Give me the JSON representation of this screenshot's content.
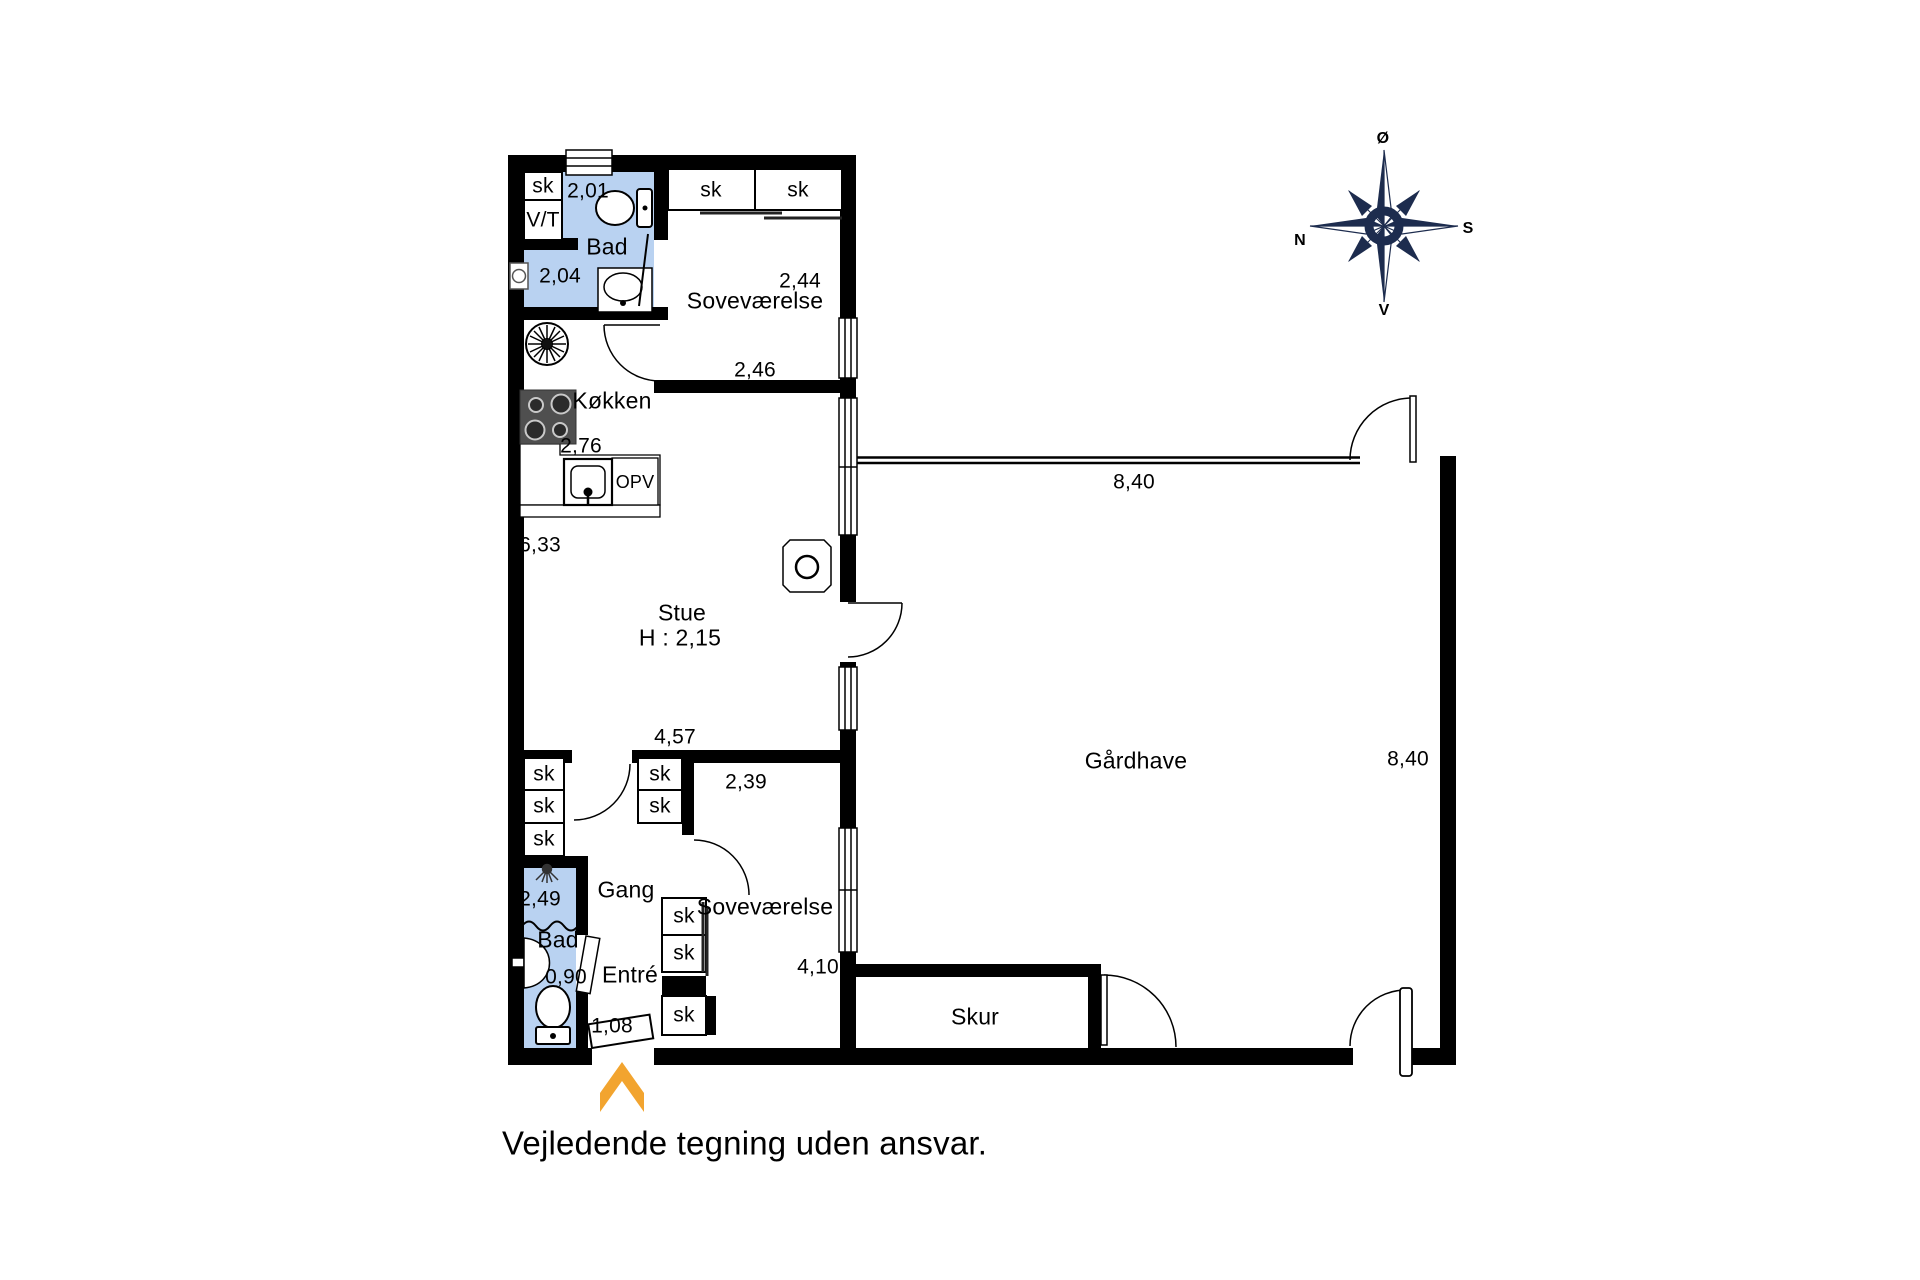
{
  "note": "Vejledende tegning uden ansvar.",
  "colors": {
    "wall": "#000000",
    "wet_room_fill": "#b9d2f1",
    "compass": "#1d2c4e",
    "entrance_arrow": "#F2A42F",
    "appliance_dark": "#4f4f4f"
  },
  "compass": {
    "north": "N",
    "south": "S",
    "east": "Ø",
    "west": "V"
  },
  "rooms": {
    "bathroom_top": {
      "name": "Bad",
      "closet": "sk",
      "washer": "V/T",
      "dim_width": "2,01",
      "dim_depth": "2,04"
    },
    "bedroom_top": {
      "name": "Soveværelse",
      "closets": [
        "sk",
        "sk"
      ],
      "dim_width": "2,44",
      "dim_bottom": "2,46"
    },
    "kitchen": {
      "name": "Køkken",
      "dim_width": "2,76",
      "dishwasher": "OPV"
    },
    "living": {
      "name": "Stue",
      "ceiling": "H : 2,15",
      "dim_length": "6,33",
      "dim_width": "4,57"
    },
    "hall": {
      "name": "Gang",
      "closets": [
        "sk",
        "sk",
        "sk"
      ],
      "closets_mid": [
        "sk",
        "sk"
      ]
    },
    "bathroom_bottom": {
      "name": "Bad",
      "dim_width": "2,49",
      "dim_sink": "0,90"
    },
    "entry": {
      "name": "Entré",
      "dim_door": "1,08"
    },
    "bedroom_bottom": {
      "name": "Soveværelse",
      "dim_width": "2,39",
      "dim_length": "4,10",
      "closets": [
        "sk",
        "sk",
        "sk"
      ]
    },
    "shed": {
      "name": "Skur"
    },
    "courtyard": {
      "name": "Gårdhave",
      "dim_top": "8,40",
      "dim_right": "8,40"
    }
  }
}
